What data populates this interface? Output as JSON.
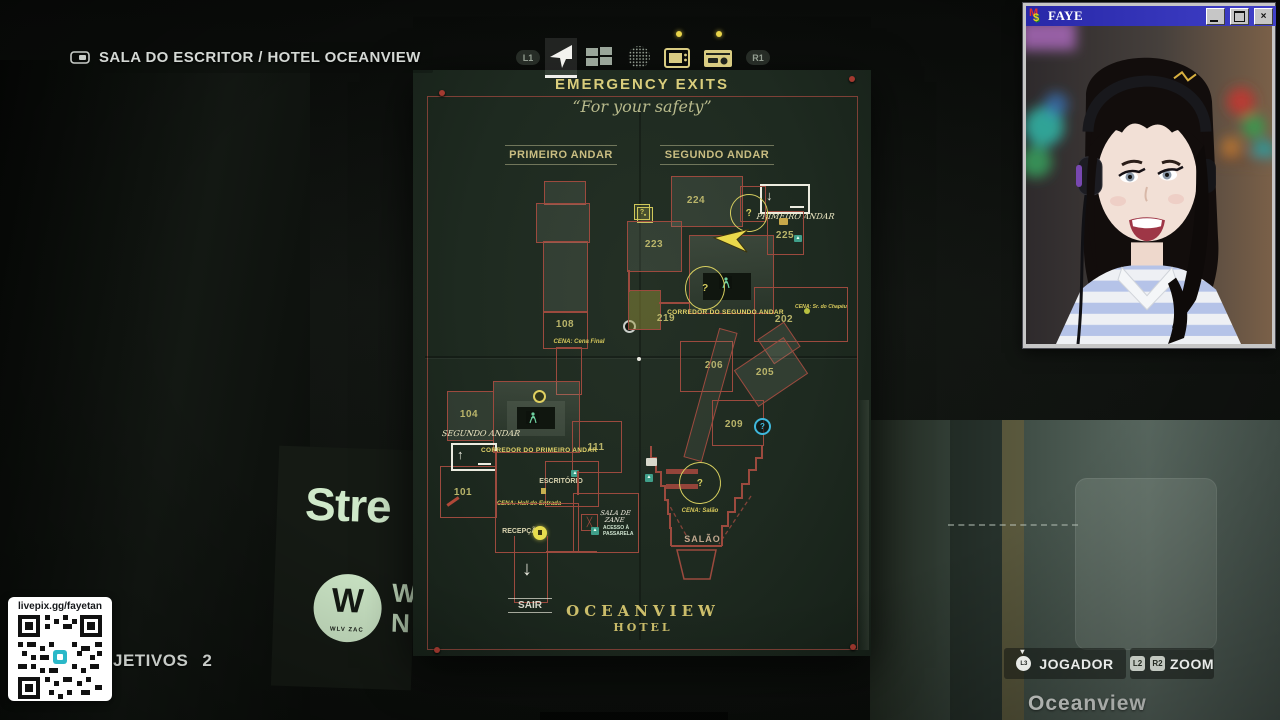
{
  "breadcrumb": {
    "text": "SALA DO ESCRITOR / HOTEL OCEANVIEW"
  },
  "tabbar": {
    "l1": "L1",
    "r1": "R1",
    "icons": [
      "navigation-arrow",
      "case-board",
      "echo-sphere",
      "tv",
      "radio"
    ],
    "selected": "navigation-arrow"
  },
  "map": {
    "title": "EMERGENCY EXITS",
    "subtitle": "“For your safety”",
    "floors": {
      "left": "PRIMEIRO ANDAR",
      "right": "SEGUNDO ANDAR"
    },
    "rooms": {
      "r101": "101",
      "r104": "104",
      "r108": "108",
      "r111": "111",
      "r202": "202",
      "r205": "205",
      "r206": "206",
      "r209": "209",
      "r219": "219",
      "r223": "223",
      "r224": "224",
      "r225": "225"
    },
    "labels": {
      "corridor_first": "CORREDOR DO PRIMEIRO ANDAR",
      "corridor_second": "CORREDOR DO SEGUNDO ANDAR",
      "salao": "SALÃO",
      "sair": "SAIR",
      "recepcao": "RECEPÇÃO",
      "escritorio": "ESCRITÓRIO",
      "zane_line1": "SALA DE",
      "zane_line2": "ZANE",
      "acesso_line1": "ACESSO À",
      "acesso_line2": "PASSARELA",
      "hand_primeiro": "PRIMEIRO ANDAR",
      "hand_segundo": "SEGUNDO ANDAR"
    },
    "scenes": {
      "final": "CENA: Cena Final",
      "hall": "CENA: Hall de Entrada",
      "salao": "CENA: Salão",
      "chapeu": "CENA: Sr. do Chapéu"
    },
    "hotel": {
      "name": "OCEANVIEW",
      "type": "HOTEL"
    },
    "question_mark": "?"
  },
  "webcam": {
    "title": "FAYE",
    "close_glyph": "×"
  },
  "overlay": {
    "donation_url": "livepix.gg/fayetan",
    "objectives_label": "JETIVOS",
    "objectives_count": "2"
  },
  "hud": {
    "player": "JOGADOR",
    "zoom": "ZOOM",
    "l2": "L2",
    "r2": "R2",
    "l3": "L3"
  },
  "background": {
    "poster_text": "Stre",
    "logo_letter": "W",
    "logo_sub": "WLV ZAC",
    "side_letters": "W\nN",
    "wall_text": "Oceanview"
  }
}
